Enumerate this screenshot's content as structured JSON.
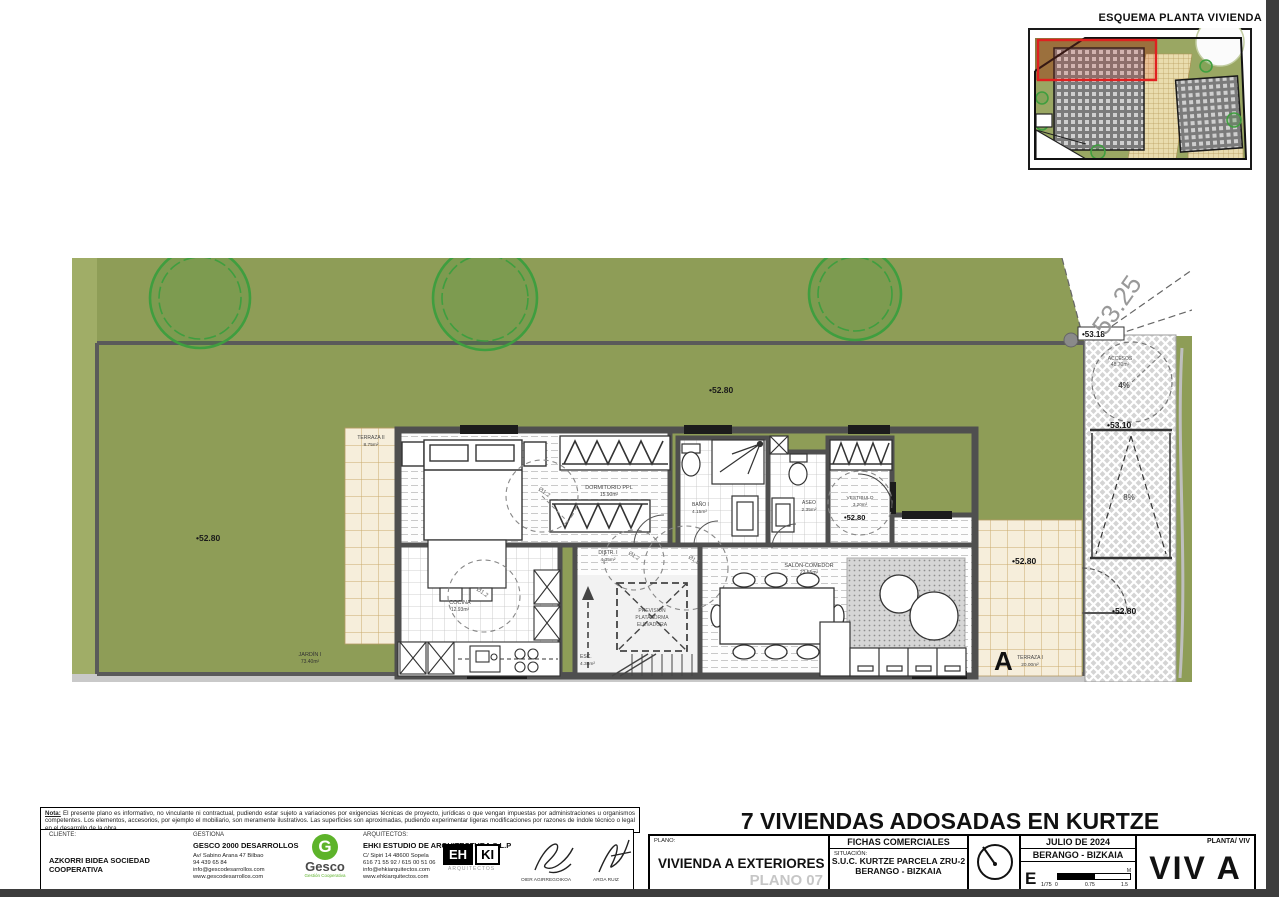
{
  "esquema": {
    "title": "ESQUEMA PLANTA VIVIENDA"
  },
  "colors": {
    "garden_green": "#8e9d57",
    "tree_green": "#3f9e3f",
    "terrace_tan": "#f6eedb",
    "highlight_red": "#e02020",
    "gesco_green": "#5db32a"
  },
  "plan": {
    "jardin": {
      "name": "JARDÍN I",
      "area": "73.40m²"
    },
    "terraza2": {
      "name": "TERRAZA II",
      "area": "8.75m²"
    },
    "terraza1": {
      "name": "TERRAZA I",
      "area": "20.00m²"
    },
    "dormitorio": {
      "name": "DORMITORIO PPL",
      "area": "15.90m²"
    },
    "bano": {
      "name": "BAÑO I",
      "area": "4.15m²"
    },
    "aseo": {
      "name": "ASEO",
      "area": "2.35m²"
    },
    "vestibulo": {
      "name": "VESTIBULO",
      "area": "3.20m²"
    },
    "distr": {
      "name": "DISTR. I",
      "area": "4.35m²"
    },
    "cocina": {
      "name": "COCINA",
      "area": "12.93m²"
    },
    "salon": {
      "name": "SALÓN-COMEDOR",
      "area": "22.55m²"
    },
    "esc": {
      "name": "ESC.",
      "area": "4.38m²"
    },
    "prevision": {
      "l1": "PREVISIÓN",
      "l2": "PLATAFORMA",
      "l3": "ELEVADORA"
    },
    "accesos": {
      "name": "ACCESOS",
      "area": "48.70m²",
      "slope_top": "4%",
      "slope_ramp": "8%"
    },
    "levels": {
      "l5280": "•52.80",
      "l5310": "•53.10",
      "l5318": "•53.18",
      "l5325": "53.25"
    },
    "circles": {
      "d12": "Ø1.2",
      "d15": "Ø1.5"
    },
    "section_a": "A"
  },
  "titleblock": {
    "project_title": "7 VIVIENDAS ADOSADAS EN KURTZE",
    "plano_label": "PLANO:",
    "plano_value": "VIVIENDA A EXTERIORES",
    "plano_number": "PLANO 07",
    "fichas": "FICHAS COMERCIALES",
    "situacion_label": "SITUACIÓN:",
    "situacion_line1": "S.U.C. KURTZE PARCELA ZRU-2",
    "situacion_line2": "BERANGO - BIZKAIA",
    "date": "JULIO DE 2024",
    "location": "BERANGO - BIZKAIA",
    "scale": {
      "e": "E",
      "ratio": "1/75",
      "t0": "0",
      "t1": "0.75",
      "t2": "1.5",
      "unit": "M"
    },
    "planta_label": "PLANTA/ VIV",
    "vivienda": "VIV A"
  },
  "firm": {
    "cliente_label": "CLIENTE:",
    "cliente_name": "AZKORRI BIDEA SOCIEDAD COOPERATIVA",
    "gestiona_label": "GESTIONA",
    "gestiona_name": "GESCO 2000 DESARROLLOS",
    "gestiona_addr1": "Av/ Sabino Arana 47 Bilbao",
    "gestiona_addr2": "94 439 65 84",
    "gestiona_addr3": "info@gescodesarrollos.com",
    "gestiona_addr4": "www.gescodesarrollos.com",
    "gesco_letter": "G",
    "gesco_word": "Gesco",
    "gesco_tagline": "Gestión Cooperativa",
    "arquitectos_label": "ARQUITECTOS:",
    "arquitectos_name": "EHKI ESTUDIO DE ARQUITECTURA S.L.P",
    "arquitectos_addr1": "C/ Sipiri 14 48600 Sopela",
    "arquitectos_addr2": "616 71 55 92 / 615 00 51 06",
    "arquitectos_addr3": "info@ehkiarquitectos.com",
    "arquitectos_addr4": "www.ehkiarquitectos.com",
    "ehki_eh": "EH",
    "ehki_ki": "KI",
    "ehki_sub": "ARQUITECTOS",
    "sig1_name": "OIER AGIRREGOIKOA",
    "sig2_name": "AROA RUIZ"
  },
  "nota": {
    "label": "Nota:",
    "text": " El presente plano es informativo, no vinculante ni contractual, pudiendo estar sujeto a variaciones por exigencias técnicas de proyecto, jurídicas o que vengan impuestas por administraciones u organismos competentes. Los elementos, accesorios, por ejemplo el mobiliario, son meramente ilustrativos. Las superficies son aproximadas, pudiendo experimentar ligeras modificaciones por razones de índole técnico o legal en el desarrollo de la obra."
  }
}
